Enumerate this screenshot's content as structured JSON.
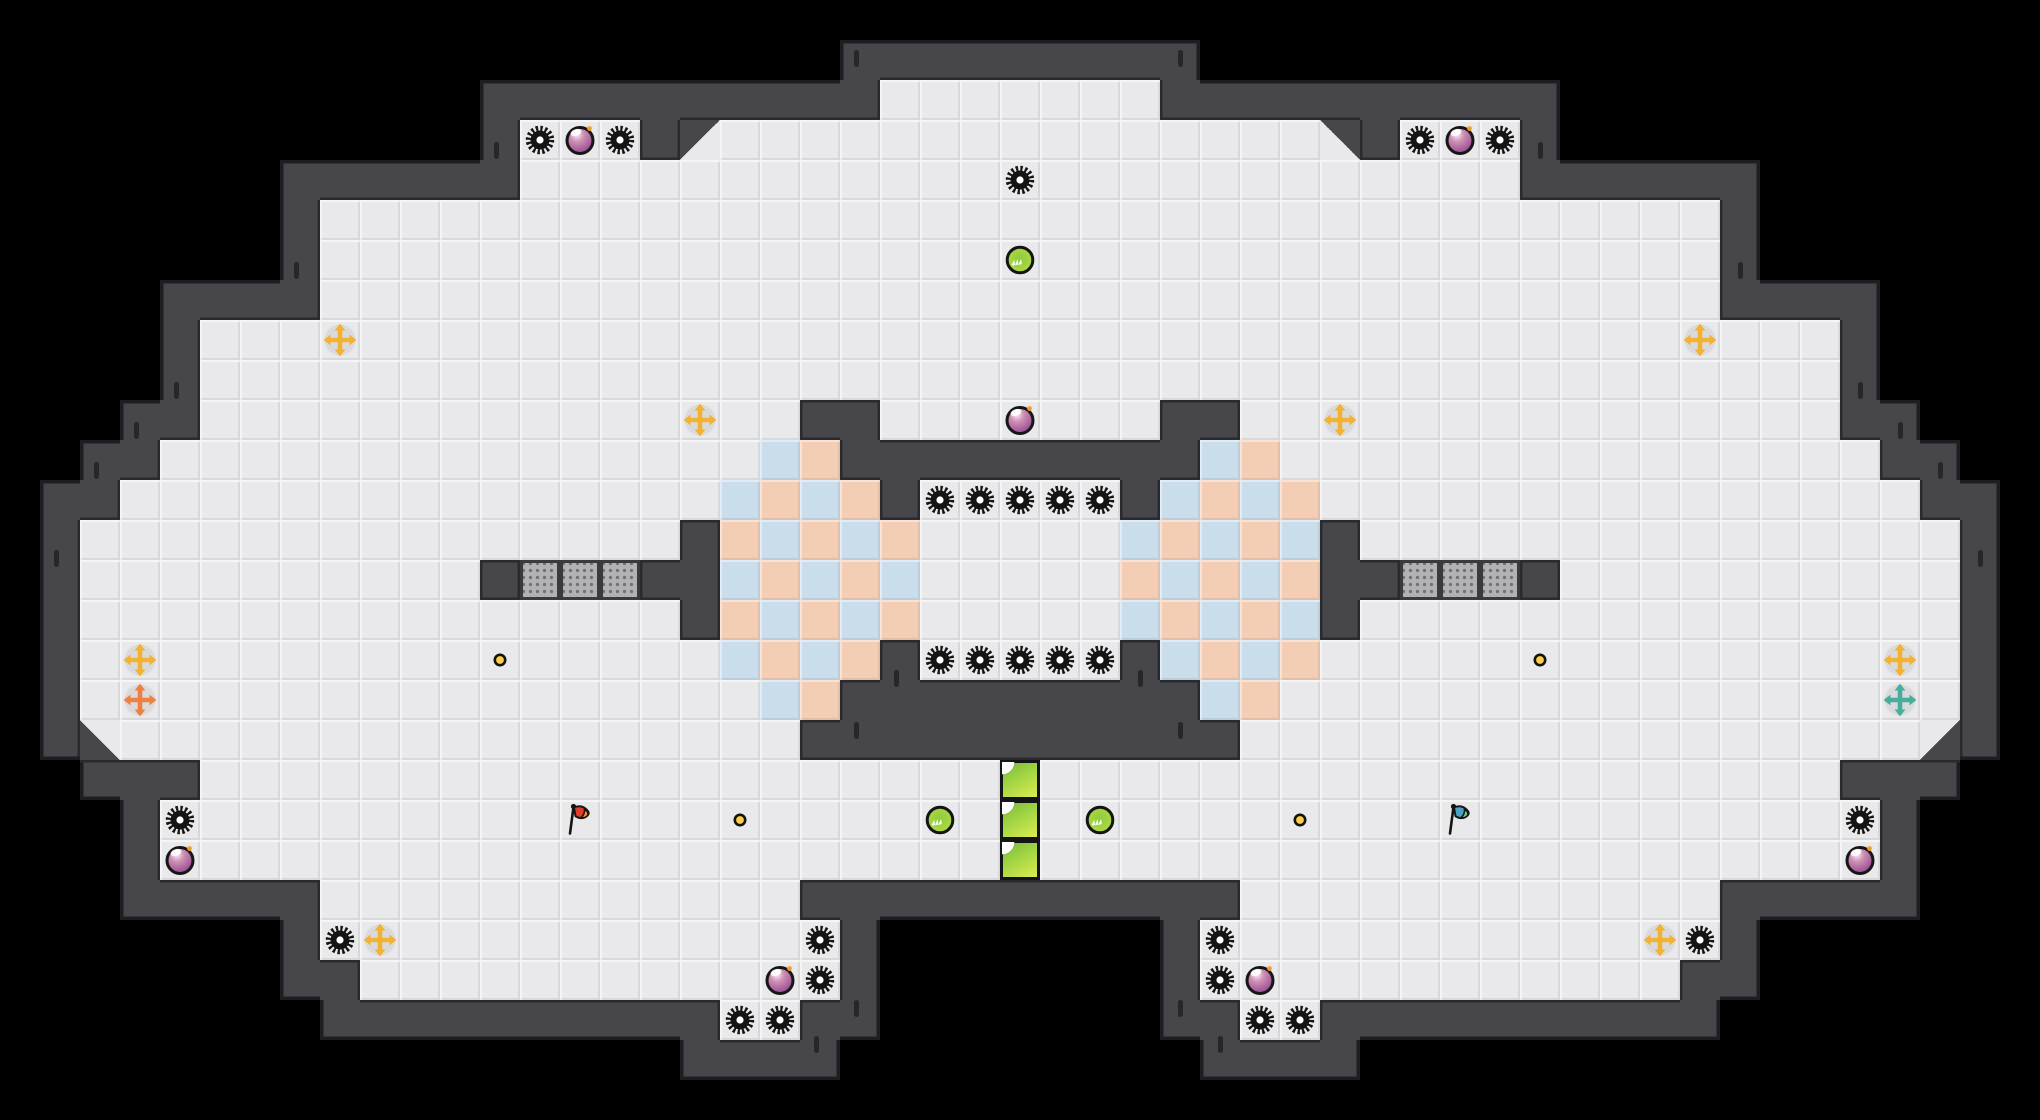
{
  "meta": {
    "cols": 51,
    "rows": 28,
    "tile": 40
  },
  "palette": {
    "bg": "#000000",
    "wall": "#47474b",
    "wallInnerLine": "#2a2a2e",
    "wallOuterLine": "#1e1e22",
    "floor": "#e9e9eb",
    "pink": "#f3cdb4",
    "blue": "#c9ddeb",
    "dottedBg": "#b2b2b6",
    "dottedDot": "#717176",
    "dottedBorder": "#3a3a3e",
    "gold": "#f2b233",
    "orange": "#ee8142",
    "teal": "#48ae9b",
    "dotFill": "#ffd23f",
    "gearFill": "#141414",
    "greenBlock1": "#8cc63f",
    "greenBlock2": "#d9ea4d",
    "flagRed": "#e23c2d",
    "flagRedTip": "#f2921f",
    "flagTeal": "#4aa3c4",
    "flagTealTip": "#6cc97f"
  },
  "map": {
    "legend": {
      " ": "void",
      ".": "floor",
      "P": "checker-pink",
      "B": "checker-blue",
      "D": "dotted-platform",
      "G": "green-block",
      "a": "diag-wall-top-left",
      "b": "diag-wall-top-right",
      "c": "diag-wall-bottom-left",
      "d": "diag-wall-bottom-right"
    },
    "rows": [
      "                                                   ",
      "                                                   ",
      "                      .......                      ",
      "             ... a...............b ...             ",
      "             .........................             ",
      "        ...................................        ",
      "        ...................................        ",
      "        ...................................        ",
      "     .........................................     ",
      "     .........................................     ",
      "     ...............  .......  ...............     ",
      "    ...............BP         BP...............    ",
      "   ...............BPBP ..... BPBP...............   ",
      "  ............... PBPBP.....BPBPB ...............  ",
      "  .......... DDD  BPBPB.....PBPBP  DDD ..........  ",
      "  ............... PBPBP.....BPBPB ...............  ",
      "  ................BPBP ..... BPBP................  ",
      "  .................BP         BP.................  ",
      "  c.................           .................d  ",
      "     ....................G....................     ",
      "    .....................G.....................    ",
      "    .....................G.....................    ",
      "        ............           ............        ",
      "        .............         .............        ",
      "         ............         ............         ",
      "                  ..           ..                  ",
      "                                                   ",
      "                                                   "
    ]
  },
  "entities": {
    "gears": [
      [
        13,
        3
      ],
      [
        15,
        3
      ],
      [
        35,
        3
      ],
      [
        37,
        3
      ],
      [
        25,
        4
      ],
      [
        23,
        12
      ],
      [
        24,
        12
      ],
      [
        25,
        12
      ],
      [
        26,
        12
      ],
      [
        27,
        12
      ],
      [
        23,
        16
      ],
      [
        24,
        16
      ],
      [
        25,
        16
      ],
      [
        26,
        16
      ],
      [
        27,
        16
      ],
      [
        4,
        20
      ],
      [
        46,
        20
      ],
      [
        8,
        23
      ],
      [
        42,
        23
      ],
      [
        20,
        23
      ],
      [
        30,
        23
      ],
      [
        20,
        24
      ],
      [
        30,
        24
      ],
      [
        18,
        25
      ],
      [
        19,
        25
      ],
      [
        31,
        25
      ],
      [
        32,
        25
      ]
    ],
    "orbs": [
      [
        14,
        3
      ],
      [
        36,
        3
      ],
      [
        25,
        10
      ],
      [
        4,
        21
      ],
      [
        46,
        21
      ],
      [
        19,
        24
      ],
      [
        31,
        24
      ]
    ],
    "crosses": [
      {
        "c": 8,
        "r": 8,
        "color": "gold"
      },
      {
        "c": 42,
        "r": 8,
        "color": "gold"
      },
      {
        "c": 17,
        "r": 10,
        "color": "gold"
      },
      {
        "c": 33,
        "r": 10,
        "color": "gold"
      },
      {
        "c": 3,
        "r": 16,
        "color": "gold"
      },
      {
        "c": 47,
        "r": 16,
        "color": "gold"
      },
      {
        "c": 3,
        "r": 17,
        "color": "orange"
      },
      {
        "c": 47,
        "r": 17,
        "color": "teal"
      },
      {
        "c": 9,
        "r": 23,
        "color": "gold"
      },
      {
        "c": 41,
        "r": 23,
        "color": "gold"
      }
    ],
    "dots": [
      [
        12,
        16
      ],
      [
        38,
        16
      ],
      [
        18,
        20
      ],
      [
        32,
        20
      ]
    ],
    "bouncers": [
      [
        25,
        6
      ],
      [
        23,
        20
      ],
      [
        27,
        20
      ]
    ],
    "flags": [
      {
        "c": 14,
        "r": 20,
        "color": "red"
      },
      {
        "c": 36,
        "r": 20,
        "color": "teal"
      }
    ],
    "wall_ticks": [
      [
        12.35,
        3.55
      ],
      [
        38.45,
        3.55
      ],
      [
        21.35,
        1.25
      ],
      [
        29.45,
        1.25
      ],
      [
        7.35,
        6.55
      ],
      [
        43.45,
        6.55
      ],
      [
        4.35,
        9.55
      ],
      [
        46.45,
        9.55
      ],
      [
        3.35,
        10.55
      ],
      [
        47.45,
        10.55
      ],
      [
        2.35,
        11.55
      ],
      [
        48.45,
        11.55
      ],
      [
        1.35,
        13.75
      ],
      [
        49.45,
        13.75
      ],
      [
        22.35,
        16.75
      ],
      [
        28.45,
        16.75
      ],
      [
        21.35,
        18.05
      ],
      [
        29.45,
        18.05
      ],
      [
        21.35,
        25.0
      ],
      [
        29.45,
        25.0
      ],
      [
        20.35,
        25.9
      ],
      [
        30.45,
        25.9
      ]
    ]
  }
}
